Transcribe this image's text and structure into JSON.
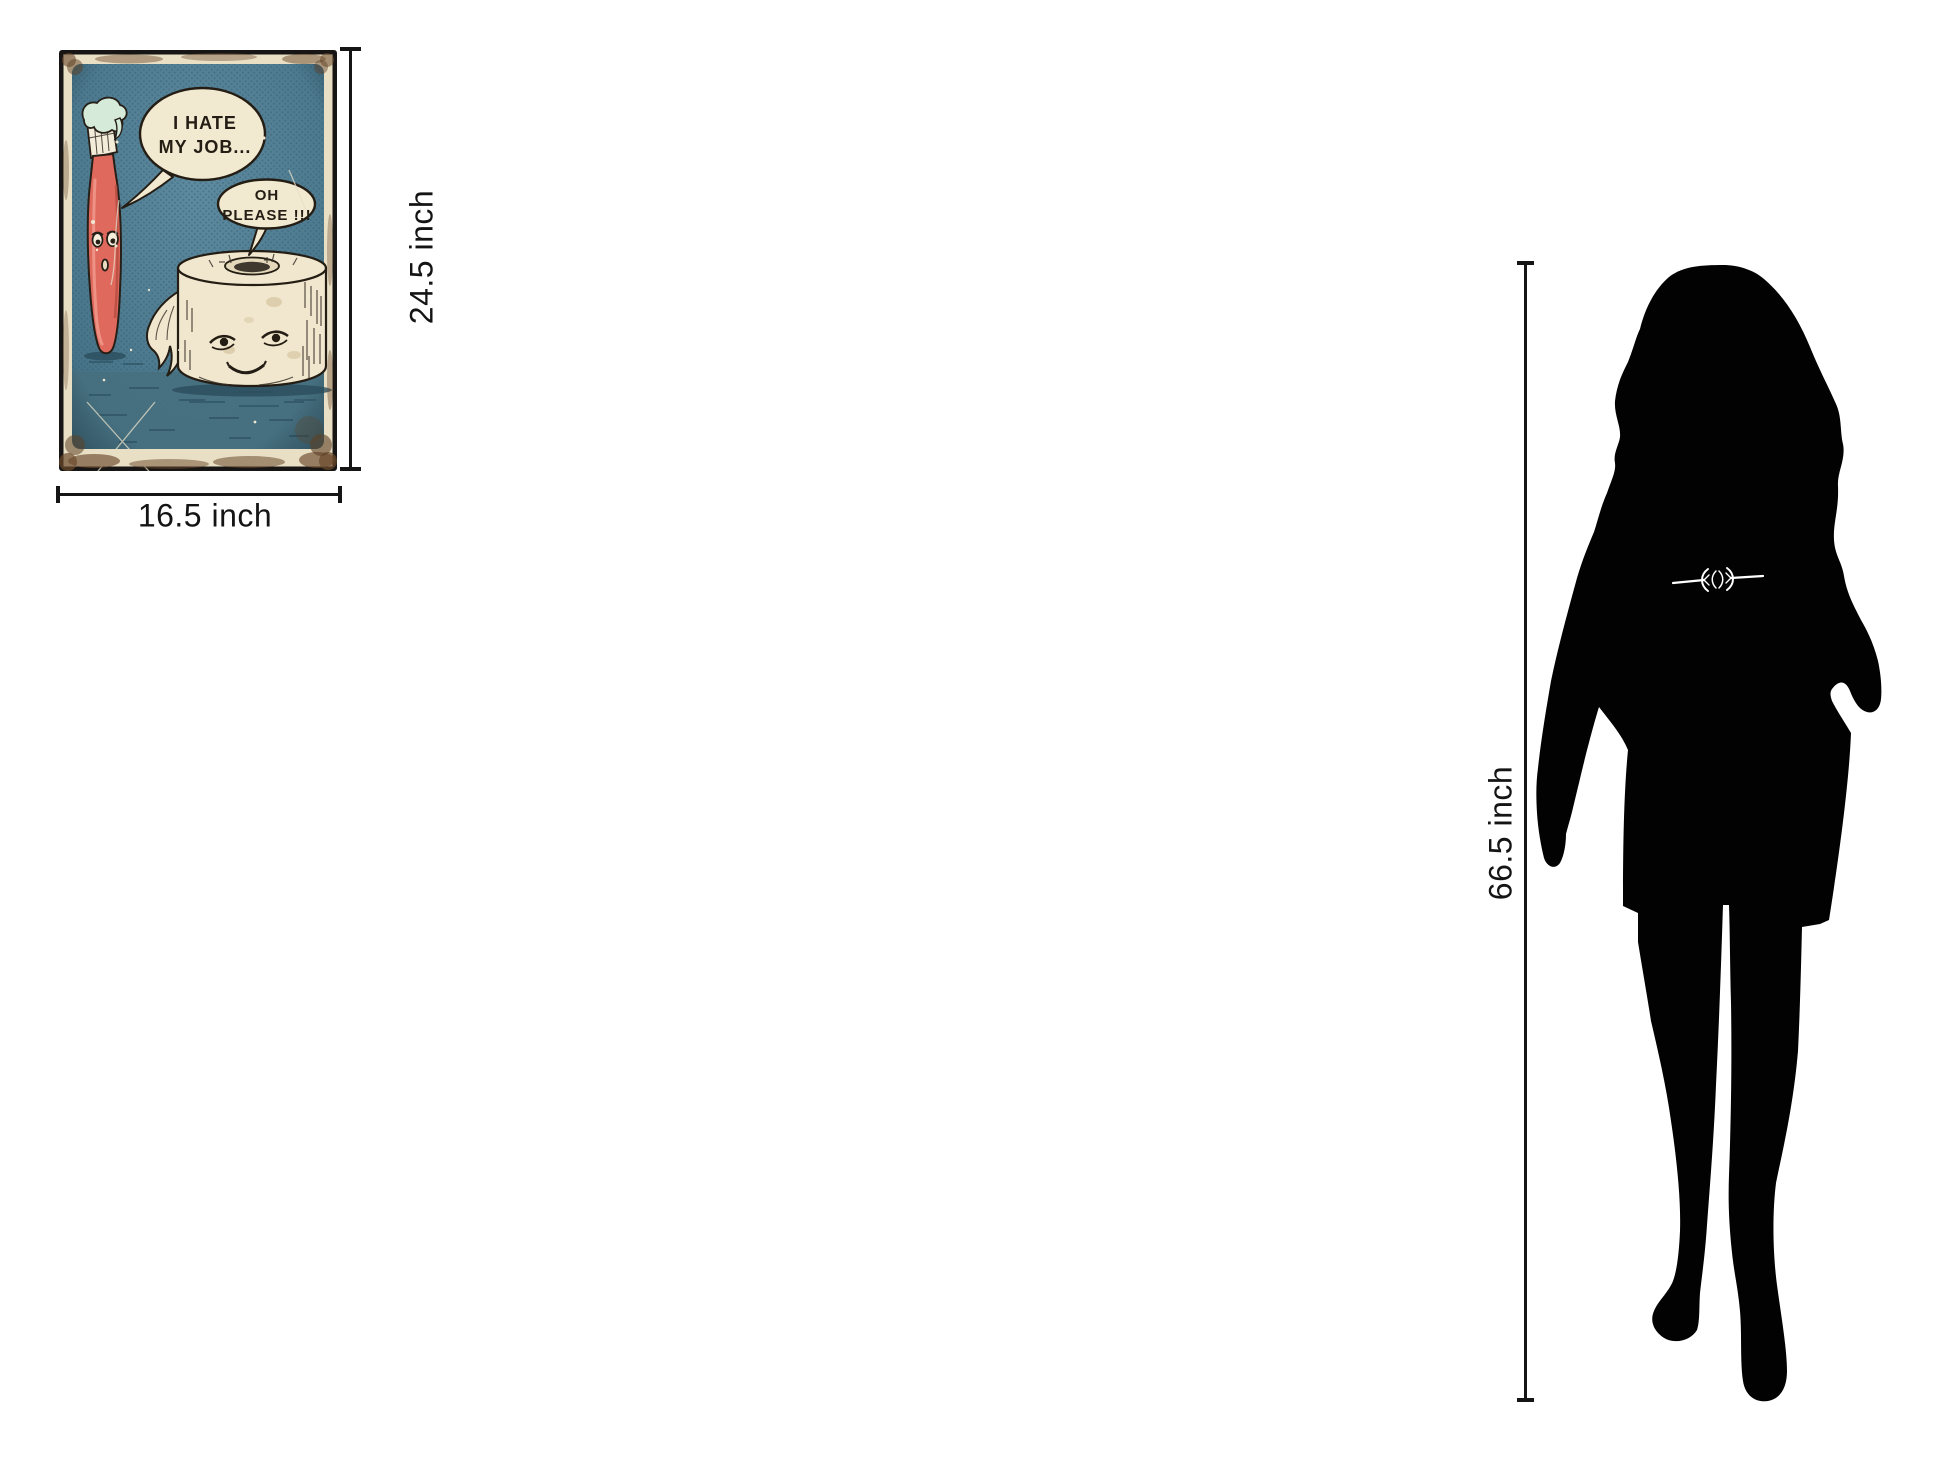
{
  "annotations": {
    "poster_height": "24.5 inch",
    "poster_width": "16.5 inch",
    "figure_height": "66.5 inch"
  },
  "poster": {
    "bubbles": {
      "toothbrush": {
        "line1": "I HATE",
        "line2": "MY JOB..."
      },
      "toilet_paper": {
        "line1": "OH",
        "line2": "PLEASE !!!"
      }
    },
    "colors": {
      "frame": "#181614",
      "border_paper": "#e9dfc5",
      "background_teal": "#4e7b90",
      "ground_teal": "#46707f",
      "toothbrush_red": "#e0695d",
      "toothpaste_mint": "#d5ead8",
      "paper_cream": "#f1e7ce",
      "bubble_fill": "#f2e9d1",
      "ink": "#251f18"
    }
  },
  "figure": {
    "name": "woman-silhouette",
    "color": "#020202"
  }
}
